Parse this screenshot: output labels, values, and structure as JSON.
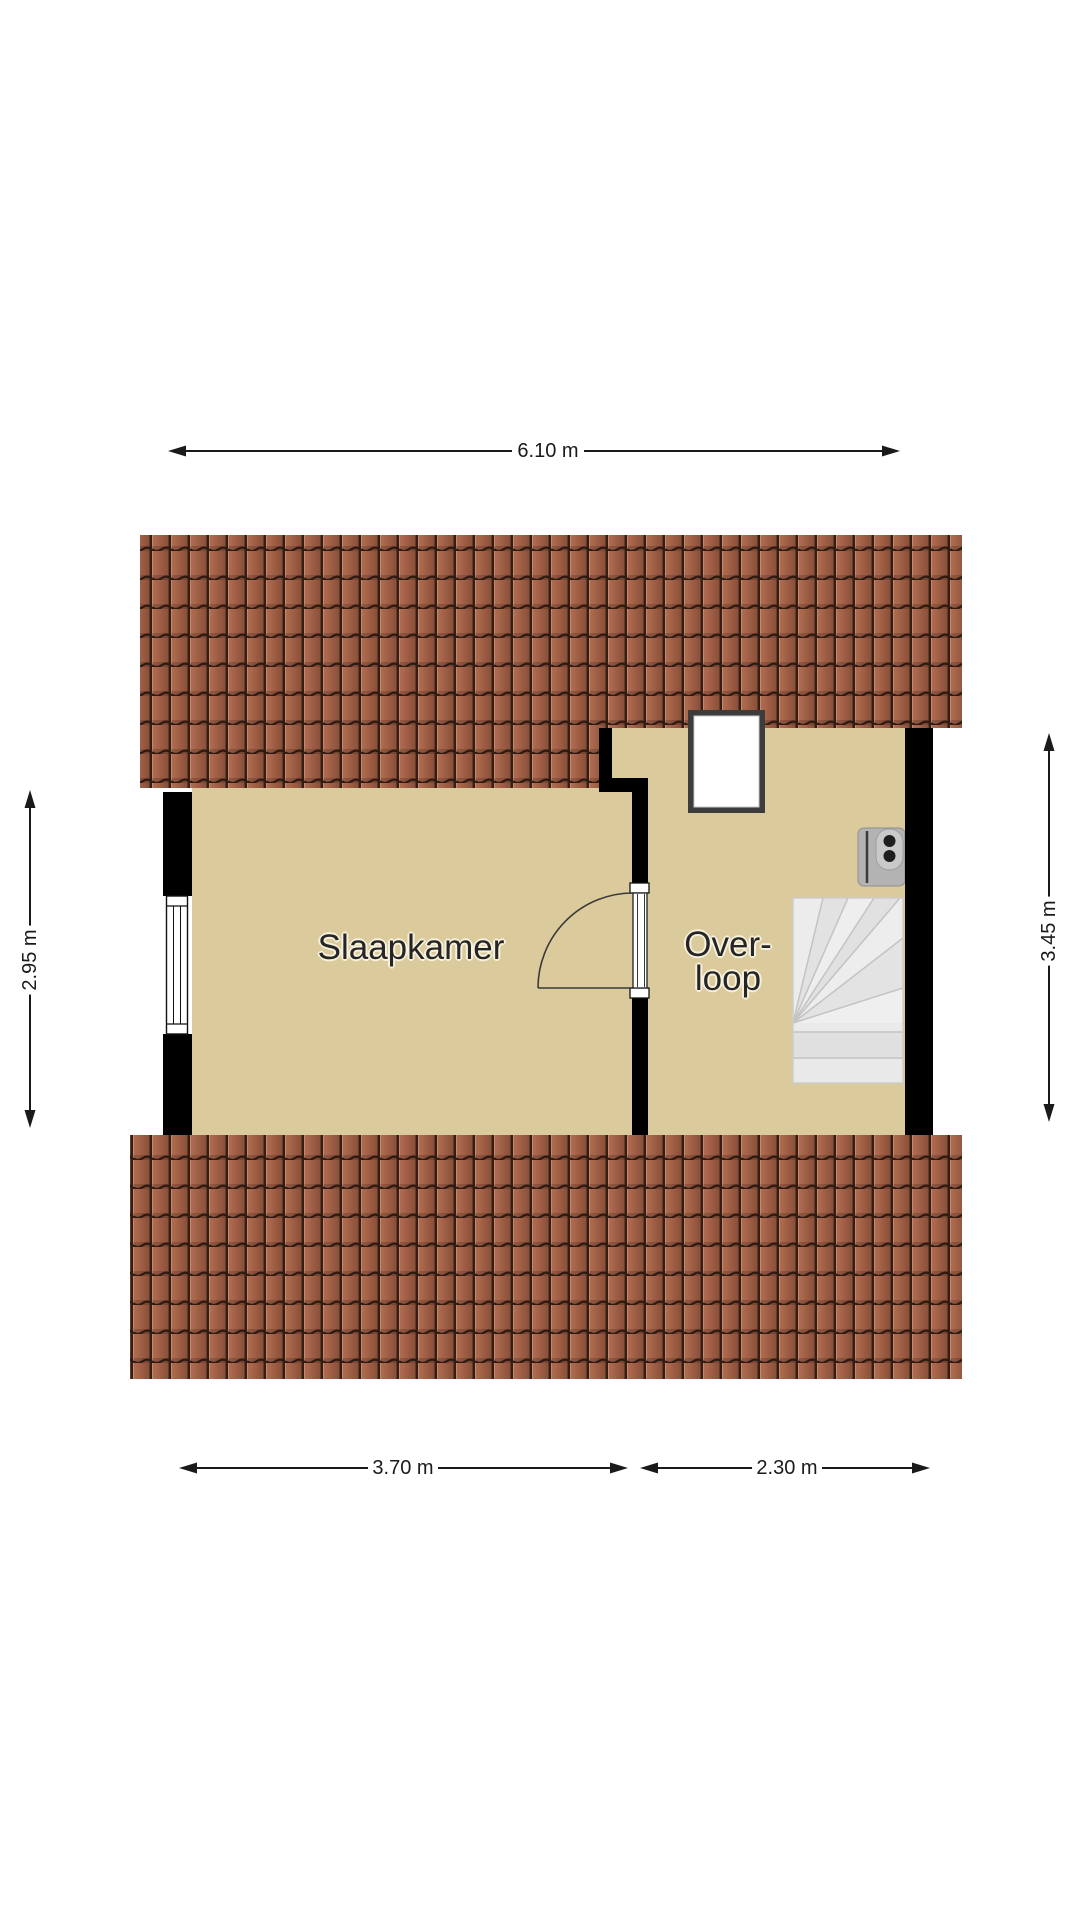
{
  "floorplan": {
    "rooms": [
      {
        "label": "Slaapkamer"
      },
      {
        "label_lines": [
          "Over-",
          "loop"
        ]
      }
    ],
    "dimensions": {
      "top": "6.10 m",
      "left": "2.95 m",
      "right": "3.45 m",
      "bottom_left": "3.70 m",
      "bottom_right": "2.30 m"
    },
    "colors": {
      "background": "#ffffff",
      "floor": "#dbca9b",
      "wall": "#000000",
      "roof_tile": "#9c5c44",
      "roof_joint": "#2e1a11",
      "stairs": "#e7e7e7",
      "skylight_frame": "#3c3c3c",
      "dimension": "#1a1a1a"
    }
  }
}
